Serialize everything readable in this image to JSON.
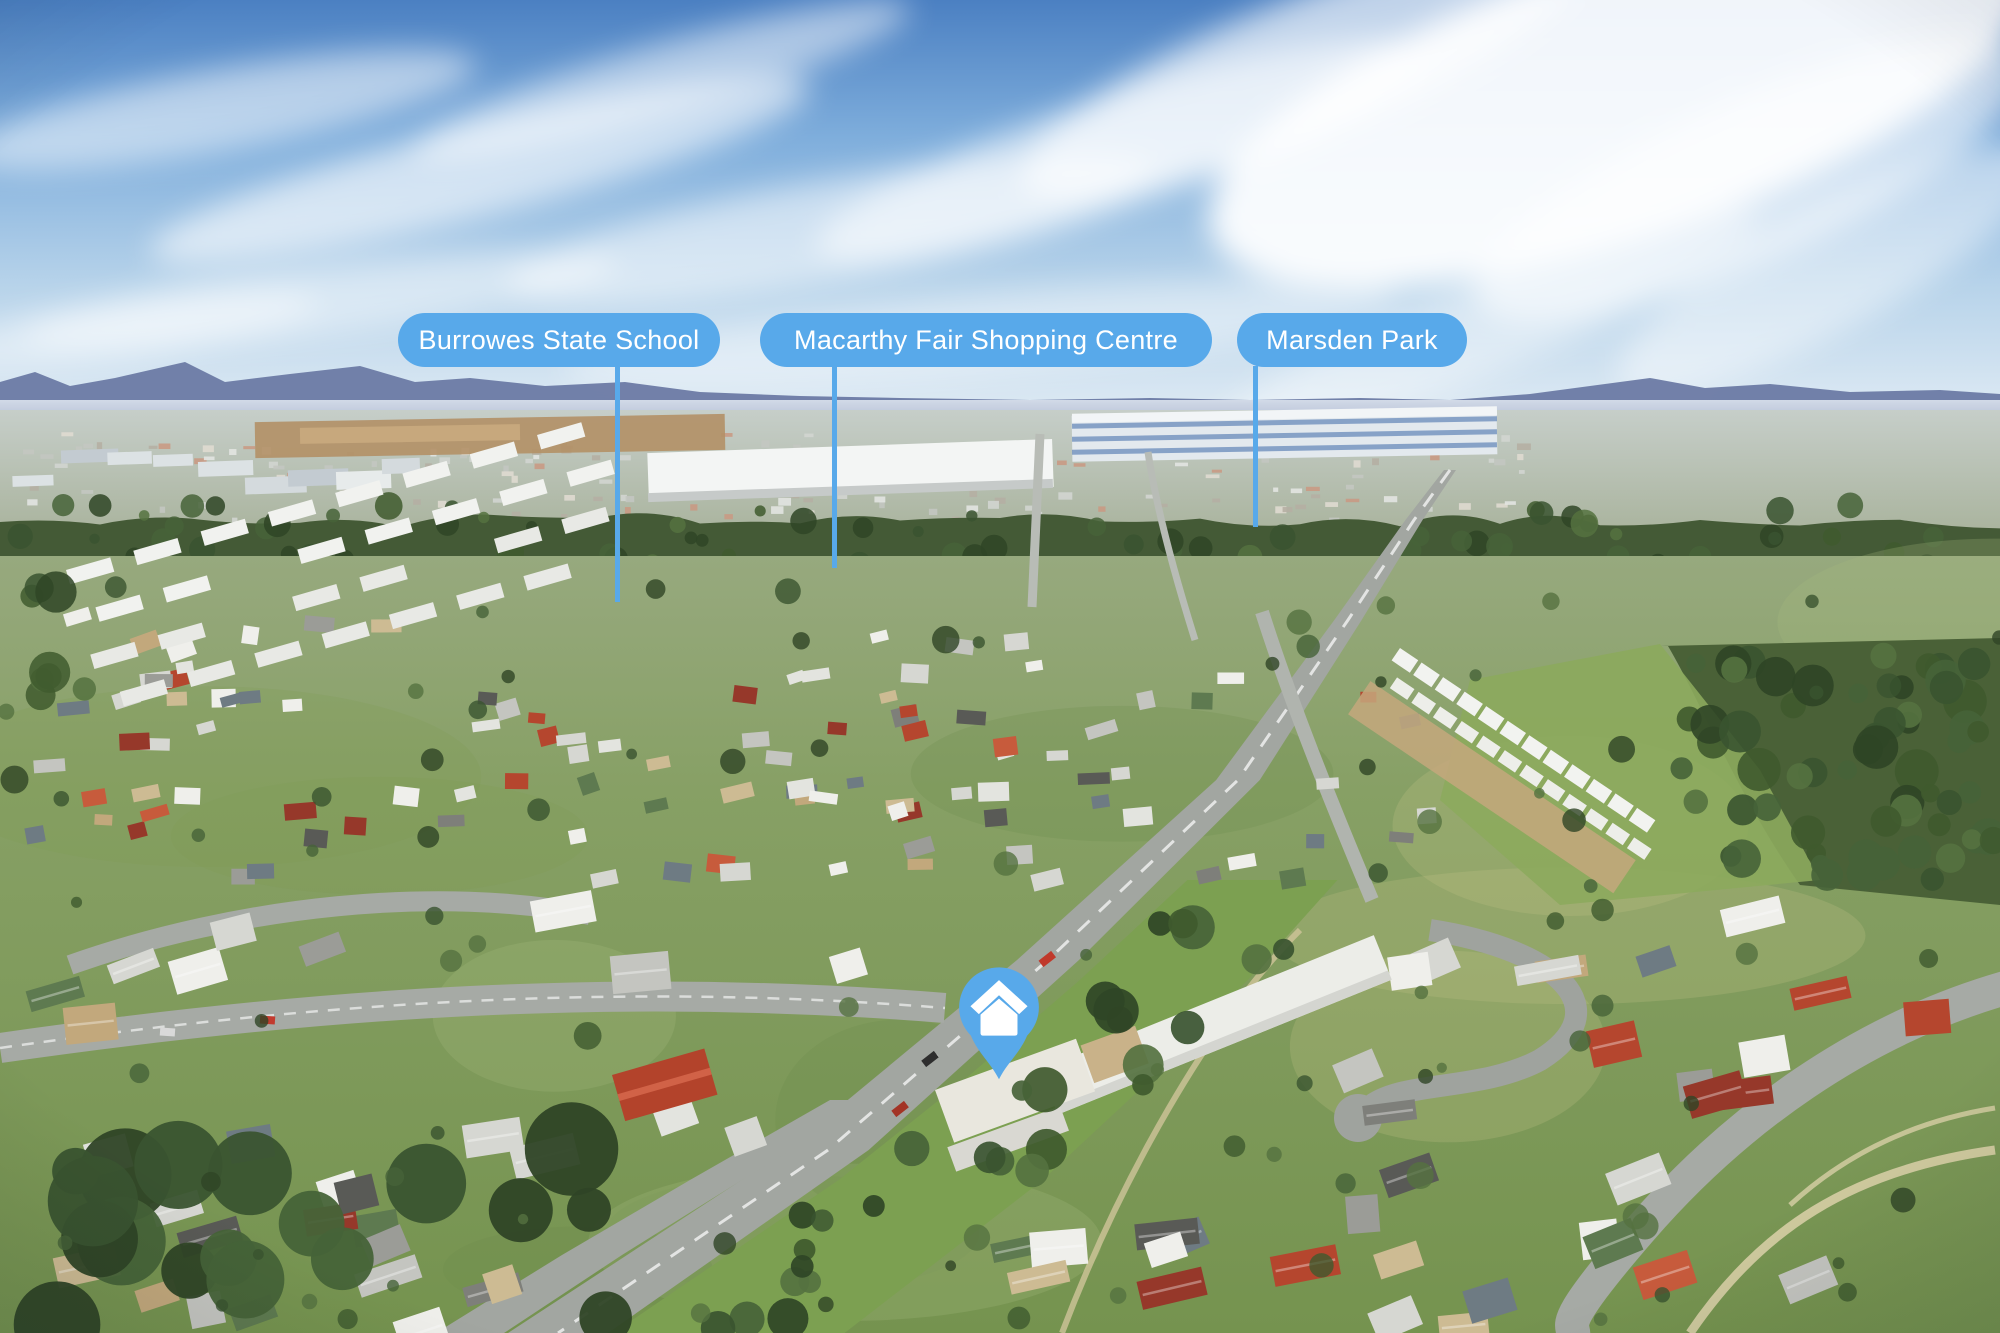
{
  "annotations": {
    "accent_color": "#58A9EA",
    "label_text_color": "#FFFFFF",
    "labels": [
      {
        "id": "burrowes-state-school",
        "text": "Burrowes State School"
      },
      {
        "id": "macarthy-fair-shopping-centre",
        "text": "Macarthy Fair Shopping Centre"
      },
      {
        "id": "marsden-park",
        "text": "Marsden Park"
      }
    ],
    "marker": {
      "icon": "house-icon",
      "color": "#58A9EA",
      "glyph_color": "#FFFFFF"
    }
  },
  "scene": {
    "description_colors": {
      "sky_top": "#4B80C2",
      "sky_horizon": "#E3EDF5",
      "mountains": "#6C7AA4",
      "grass": "#87A065",
      "asphalt": "#A2A6A1"
    }
  }
}
